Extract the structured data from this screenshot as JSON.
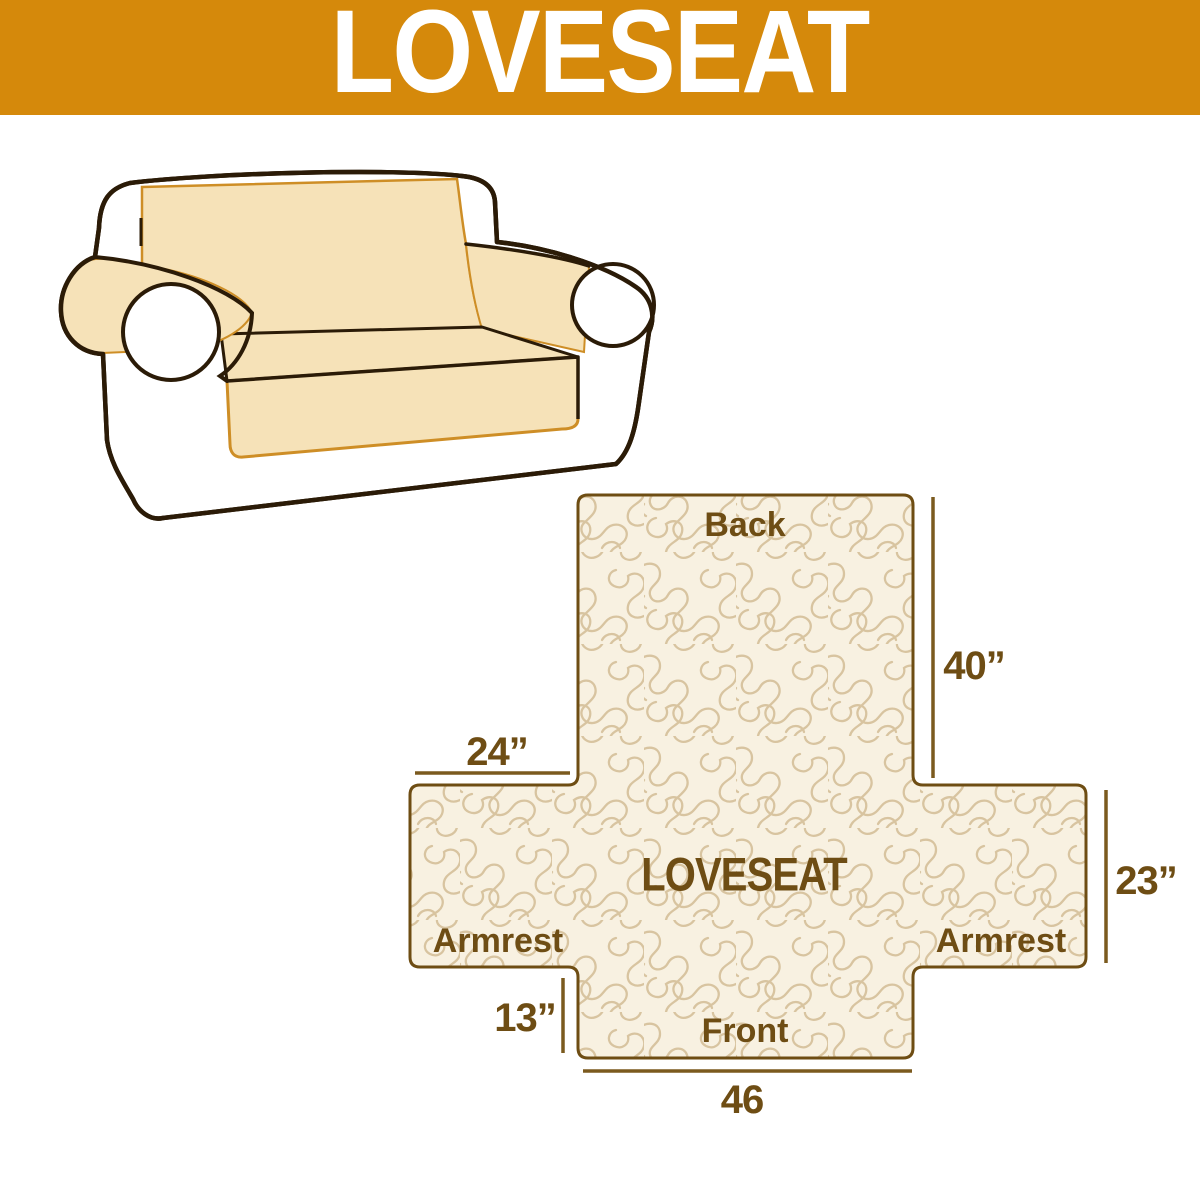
{
  "banner": {
    "title": "LOVESEAT"
  },
  "sofa_illustration": {
    "description": "line sketch of a two-seat loveseat with tan slipcover over back, seat and armrests"
  },
  "diagram": {
    "center_label": "LOVESEAT",
    "back_label": "Back",
    "front_label": "Front",
    "armrest_left_label": "Armrest",
    "armrest_right_label": "Armrest",
    "dim_back_height": "40”",
    "dim_armrest_width": "24”",
    "dim_side_height": "23”",
    "dim_front_skirt": "13”",
    "dim_front_width": "46"
  },
  "colors": {
    "banner_bg": "#D5890B",
    "banner_text": "#FFFFFF",
    "label_text": "#6E4D14",
    "diagram_border": "#6E4D13",
    "diagram_fill": "#F8F1E1",
    "pattern_line": "#D8C4A0",
    "measure_line": "#7B5A1E",
    "sofa_outline": "#2B1B07",
    "cover_fill": "#F6E2B8",
    "cover_accent": "#CE8E26"
  }
}
